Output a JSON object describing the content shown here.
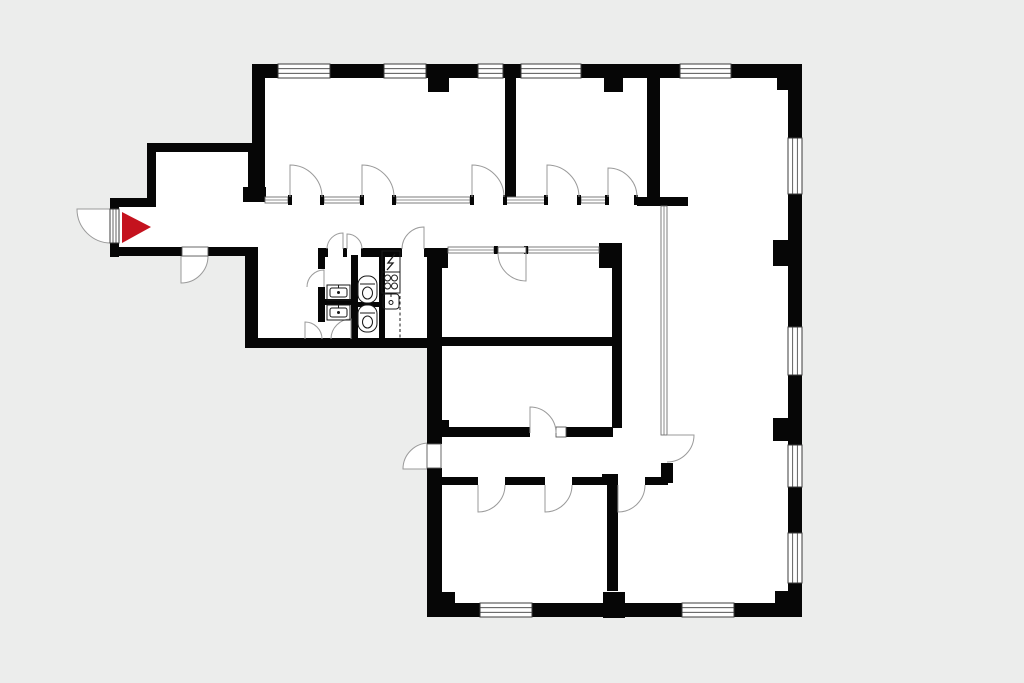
{
  "meta": {
    "title": "apartment-floor-plan",
    "background_color": "#ecedec",
    "wall_color": "#060606",
    "floor_color": "#ffffff",
    "line_color": "#9a9a9a",
    "frame_color": "#3c3c3c",
    "fixture_color": "#1a1a1a",
    "marker_color": "#c4121e"
  },
  "canvas": {
    "w": 1024,
    "h": 683
  },
  "floor": {
    "points": "252,64 802,64 802,617 427,617 427,348 245,348 245,256 110,256 110,198 147,198 147,143 252,143"
  },
  "marker": {
    "points": "122,212 122,243 151,227",
    "color": "#c4121e"
  },
  "walls": [
    [
      255,
      64,
      547,
      14
    ],
    [
      252,
      64,
      13,
      138
    ],
    [
      147,
      143,
      109,
      9
    ],
    [
      147,
      143,
      9,
      64
    ],
    [
      110,
      198,
      46,
      9
    ],
    [
      110,
      198,
      9,
      11
    ],
    [
      110,
      243,
      9,
      14
    ],
    [
      110,
      247,
      72,
      9
    ],
    [
      208,
      247,
      50,
      9
    ],
    [
      245,
      247,
      13,
      101
    ],
    [
      245,
      338,
      194,
      10
    ],
    [
      248,
      145,
      10,
      48
    ],
    [
      243,
      187,
      23,
      15
    ],
    [
      428,
      78,
      21,
      14
    ],
    [
      604,
      78,
      19,
      14
    ],
    [
      777,
      78,
      25,
      12
    ],
    [
      505,
      78,
      11,
      121
    ],
    [
      647,
      64,
      13,
      140
    ],
    [
      637,
      197,
      51,
      9
    ],
    [
      661,
      463,
      12,
      20
    ],
    [
      788,
      64,
      14,
      553
    ],
    [
      773,
      240,
      15,
      26
    ],
    [
      773,
      418,
      15,
      23
    ],
    [
      775,
      591,
      27,
      26
    ],
    [
      427,
      603,
      375,
      14
    ],
    [
      437,
      592,
      18,
      16
    ],
    [
      603,
      592,
      22,
      26
    ],
    [
      318,
      248,
      10,
      9
    ],
    [
      343,
      248,
      4,
      9
    ],
    [
      361,
      248,
      22,
      9
    ],
    [
      383,
      248,
      19,
      9
    ],
    [
      424,
      248,
      13,
      9
    ],
    [
      318,
      255,
      7,
      14
    ],
    [
      318,
      287,
      7,
      35
    ],
    [
      351,
      255,
      7,
      85
    ],
    [
      379,
      252,
      6,
      88
    ],
    [
      318,
      299,
      40,
      6
    ],
    [
      356,
      302,
      24,
      5
    ],
    [
      427,
      248,
      15,
      100
    ],
    [
      427,
      348,
      15,
      96
    ],
    [
      427,
      468,
      15,
      135
    ],
    [
      438,
      420,
      11,
      13
    ],
    [
      435,
      248,
      13,
      20
    ],
    [
      599,
      243,
      23,
      25
    ],
    [
      612,
      268,
      10,
      160
    ],
    [
      442,
      337,
      171,
      9
    ],
    [
      442,
      427,
      88,
      10
    ],
    [
      566,
      427,
      47,
      10
    ],
    [
      438,
      477,
      40,
      8
    ],
    [
      505,
      477,
      40,
      8
    ],
    [
      572,
      477,
      30,
      8
    ],
    [
      602,
      474,
      16,
      11
    ],
    [
      645,
      477,
      23,
      8
    ],
    [
      607,
      485,
      11,
      106
    ]
  ],
  "windows": [
    [
      278,
      64,
      52,
      14
    ],
    [
      384,
      64,
      42,
      14
    ],
    [
      478,
      64,
      25,
      14
    ],
    [
      521,
      64,
      60,
      14
    ],
    [
      680,
      64,
      51,
      14
    ],
    [
      788,
      138,
      14,
      56
    ],
    [
      788,
      327,
      14,
      48
    ],
    [
      788,
      445,
      14,
      42
    ],
    [
      788,
      533,
      14,
      50
    ],
    [
      480,
      603,
      52,
      14
    ],
    [
      682,
      603,
      52,
      14
    ],
    [
      110,
      209,
      9,
      34
    ]
  ],
  "partitions": [
    [
      265,
      197,
      23,
      6
    ],
    [
      324,
      197,
      36,
      6
    ],
    [
      396,
      197,
      74,
      6
    ],
    [
      506,
      197,
      39,
      6
    ],
    [
      581,
      197,
      25,
      6
    ],
    [
      448,
      247,
      46,
      6
    ],
    [
      528,
      247,
      71,
      6
    ],
    [
      661,
      206,
      6,
      229
    ]
  ],
  "jambs": [
    [
      288,
      195,
      4,
      10
    ],
    [
      320,
      195,
      4,
      10
    ],
    [
      360,
      195,
      4,
      10
    ],
    [
      392,
      195,
      4,
      10
    ],
    [
      470,
      195,
      4,
      10
    ],
    [
      503,
      195,
      4,
      10
    ],
    [
      544,
      195,
      4,
      10
    ],
    [
      577,
      195,
      4,
      10
    ],
    [
      605,
      195,
      4,
      10
    ],
    [
      634,
      195,
      4,
      10
    ],
    [
      494,
      246,
      4,
      8
    ],
    [
      524,
      246,
      4,
      8
    ]
  ],
  "panels": [
    [
      182,
      247,
      26,
      9
    ],
    [
      427,
      444,
      14,
      24
    ],
    [
      556,
      427,
      10,
      10
    ],
    [
      498,
      247,
      28,
      6
    ]
  ],
  "doors": [
    {
      "hx": 290,
      "hy": 197,
      "r": 32,
      "a0": -90,
      "a1": 0,
      "fill": false
    },
    {
      "hx": 362,
      "hy": 197,
      "r": 32,
      "a0": -90,
      "a1": 0,
      "fill": false
    },
    {
      "hx": 472,
      "hy": 197,
      "r": 32,
      "a0": -90,
      "a1": 0,
      "fill": false
    },
    {
      "hx": 547,
      "hy": 197,
      "r": 32,
      "a0": -90,
      "a1": 0,
      "fill": false
    },
    {
      "hx": 608,
      "hy": 197,
      "r": 29,
      "a0": -90,
      "a1": 0,
      "fill": false
    },
    {
      "hx": 343,
      "hy": 249,
      "r": 16,
      "a0": -90,
      "a1": 180,
      "fill": false
    },
    {
      "hx": 347,
      "hy": 249,
      "r": 15,
      "a0": -90,
      "a1": 0,
      "fill": false
    },
    {
      "hx": 424,
      "hy": 249,
      "r": 22,
      "a0": -90,
      "a1": 180,
      "fill": false
    },
    {
      "hx": 324,
      "hy": 287,
      "r": 17,
      "a0": -90,
      "a1": 180,
      "fill": false
    },
    {
      "hx": 305,
      "hy": 339,
      "r": 17,
      "a0": -90,
      "a1": 0,
      "fill": false
    },
    {
      "hx": 351,
      "hy": 339,
      "r": 20,
      "a0": -90,
      "a1": 180,
      "fill": false
    },
    {
      "hx": 526,
      "hy": 253,
      "r": 28,
      "a0": 90,
      "a1": 180,
      "fill": false
    },
    {
      "hx": 530,
      "hy": 433,
      "r": 26,
      "a0": -90,
      "a1": 0,
      "fill": false
    },
    {
      "hx": 478,
      "hy": 485,
      "r": 27,
      "a0": 90,
      "a1": 0,
      "fill": false
    },
    {
      "hx": 545,
      "hy": 485,
      "r": 27,
      "a0": 90,
      "a1": 0,
      "fill": false
    },
    {
      "hx": 618,
      "hy": 485,
      "r": 27,
      "a0": 90,
      "a1": 0,
      "fill": false
    },
    {
      "hx": 667,
      "hy": 435,
      "r": 27,
      "a0": 0,
      "a1": 90,
      "fill": false
    },
    {
      "hx": 111,
      "hy": 209,
      "r": 34,
      "a0": 180,
      "a1": 90,
      "fill": true
    },
    {
      "hx": 181,
      "hy": 256,
      "r": 27,
      "a0": 90,
      "a1": 0,
      "fill": true
    },
    {
      "hx": 429,
      "hy": 469,
      "r": 26,
      "a0": 180,
      "a1": 270,
      "fill": true
    }
  ],
  "fixtures": [
    {
      "type": "panel",
      "x": 382,
      "y": 251,
      "w": 18,
      "h": 21
    },
    {
      "type": "stove",
      "x": 382,
      "y": 272,
      "w": 18,
      "h": 21
    },
    {
      "type": "sink",
      "x": 383,
      "y": 294,
      "w": 16,
      "h": 15
    },
    {
      "type": "basin",
      "x": 327,
      "y": 285,
      "w": 23,
      "h": 15
    },
    {
      "type": "basin",
      "x": 327,
      "y": 305,
      "w": 23,
      "h": 15
    },
    {
      "type": "wc",
      "x": 358,
      "y": 276,
      "w": 19,
      "h": 27
    },
    {
      "type": "wc",
      "x": 358,
      "y": 305,
      "w": 19,
      "h": 27
    },
    {
      "type": "counter",
      "x1": 400,
      "y1": 252,
      "x2": 400,
      "y2": 339
    }
  ]
}
